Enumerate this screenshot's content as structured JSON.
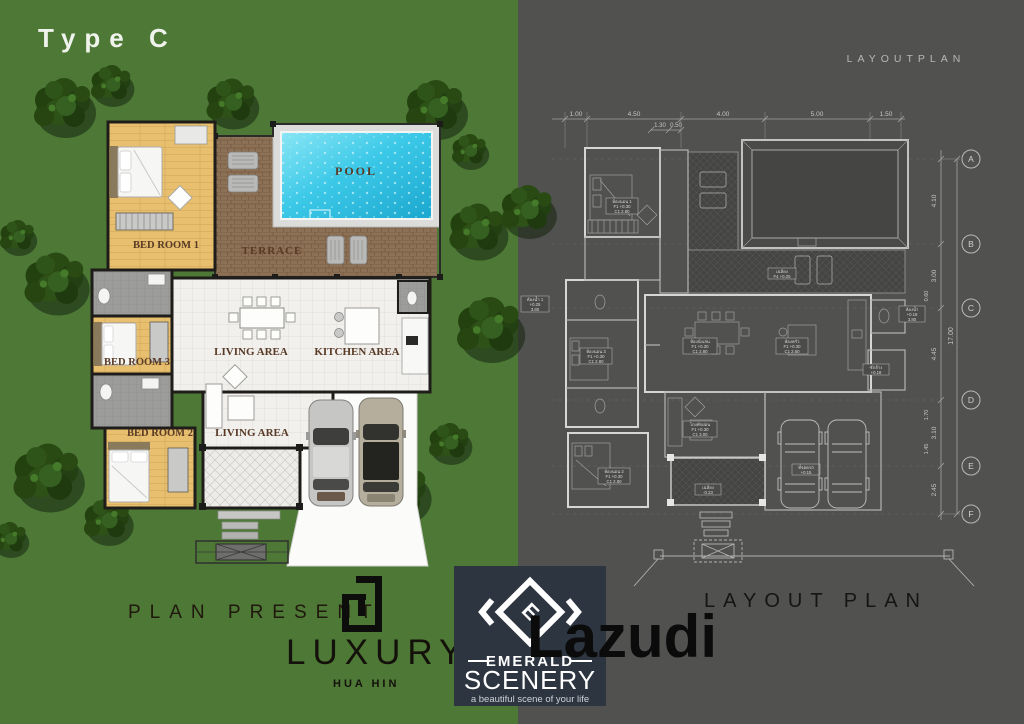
{
  "title": {
    "type_label": "Type C"
  },
  "colored_plan": {
    "rooms": {
      "bedroom1": "BED ROOM 1",
      "bedroom3": "BED ROOM 3",
      "bedroom2": "BED ROOM 2",
      "living_main": "LIVING AREA",
      "living_second": "LIVING AREA",
      "kitchen": "KITCHEN AREA",
      "terrace": "TERRACE",
      "pool": "POOL"
    }
  },
  "layout_plan": {
    "header": "LAYOUTPLAN",
    "footer_title": "LAYOUT PLAN",
    "grid_rows": [
      "A",
      "B",
      "C",
      "D",
      "E",
      "F"
    ],
    "dims_top": [
      "1.00",
      "4.50",
      "4.00",
      "5.00",
      "1.50"
    ],
    "dims_top_minor": [
      "1.30",
      "0.50"
    ],
    "dims_right": [
      "4.10",
      "3.00",
      "4.45",
      "3.10",
      "2.45"
    ],
    "dims_right_minor": [
      "0.60",
      "1.70",
      "1.45"
    ],
    "dim_total": "17.00",
    "micro_labels": [
      {
        "name": "ห้องนอน 1",
        "row1": "F1 +0.30",
        "row2": "C1 2.80"
      },
      {
        "name": "ห้องนอน 3",
        "row1": "F1 +0.30",
        "row2": "C1 2.80"
      },
      {
        "name": "ห้องนอน 2",
        "row1": "F1 +0.30",
        "row2": "C1 2.80"
      },
      {
        "name": "ห้องนั่งเล่น",
        "row1": "F1 +0.30",
        "row2": "C1 2.80"
      },
      {
        "name": "ห้องครัว",
        "row1": "F1 +0.30",
        "row2": "C1 2.60"
      },
      {
        "name": "เฉลียง",
        "row1": "F4 +0.25",
        "row2": ""
      },
      {
        "name": "โถงพักผ่อน",
        "row1": "F1 +0.30",
        "row2": "C1 3.00"
      },
      {
        "name": "เฉลียง",
        "row1": "-0.23",
        "row2": ""
      },
      {
        "name": "ที่จอดรถ",
        "row1": "+0.15",
        "row2": ""
      },
      {
        "name": "ห้องน้ำ",
        "row1": "+0.18",
        "row2": "3.80"
      },
      {
        "name": "ห้องน้ำ 1",
        "row1": "+0.25",
        "row2": "3.80"
      },
      {
        "name": "ซักล้าง",
        "row1": "+0.18",
        "row2": ""
      }
    ]
  },
  "branding": {
    "plan_present": "PLAN PRESENT",
    "luxury": "LUXURY",
    "hua_hin": "HUA HIN",
    "lazudi": "Lazudi",
    "emerald": "EMERALD",
    "scenery": "SCENERY",
    "tagline": "a beautiful scene of your life"
  },
  "colors": {
    "green_bg": "#4d7836",
    "gray_bg": "#515150",
    "pool_water": "#3cc9e8",
    "terrace_brown": "#8d7156",
    "wood_floor": "#e7bf6e",
    "label_brown": "#583a26"
  }
}
